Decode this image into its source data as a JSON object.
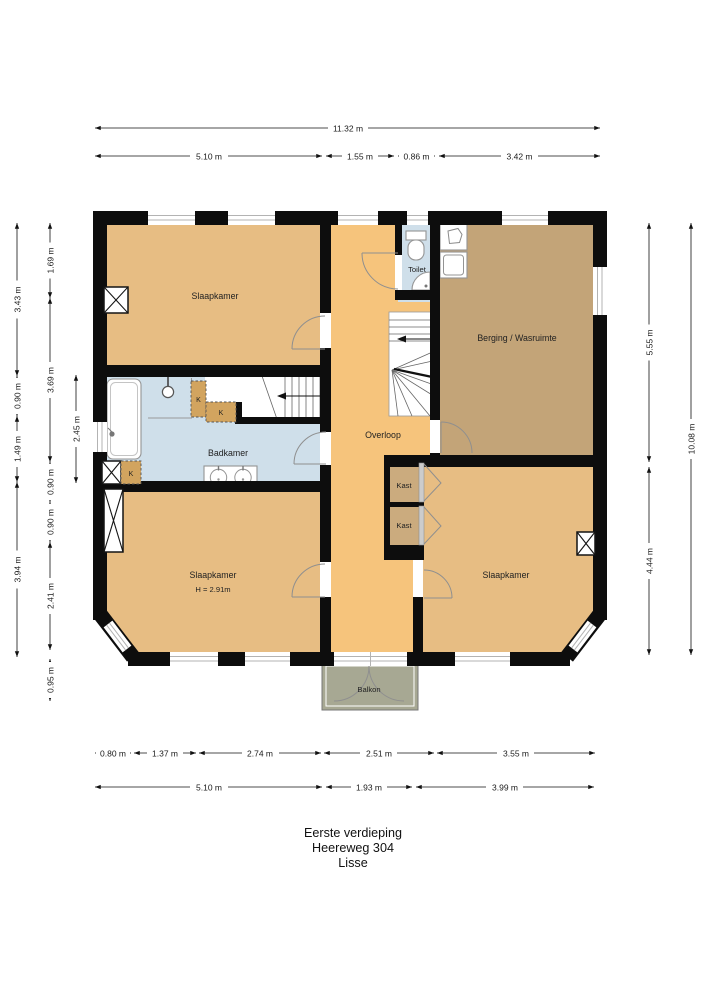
{
  "title": {
    "line1": "Eerste verdieping",
    "line2": "Heereweg 304",
    "line3": "Lisse"
  },
  "rooms": {
    "slaapkamer_tl": "Slaapkamer",
    "toilet": "Toilet",
    "berging": "Berging / Wasruimte",
    "overloop": "Overloop",
    "badkamer": "Badkamer",
    "kast1": "Kast",
    "kast2": "Kast",
    "slaapkamer_bl": "Slaapkamer",
    "slaapkamer_bl_height": "H = 2.91m",
    "slaapkamer_br": "Slaapkamer",
    "balkon": "Balkon",
    "k1": "K",
    "k2": "K",
    "k3": "K"
  },
  "dimensions": {
    "top": {
      "total": "11.32 m",
      "row2": [
        "5.10 m",
        "1.55 m",
        "0.86 m",
        "3.42 m"
      ]
    },
    "bottom": {
      "row1": [
        "0.80 m",
        "1.37 m",
        "2.74 m",
        "2.51 m",
        "3.55 m"
      ],
      "row2": [
        "5.10 m",
        "1.93 m",
        "3.99 m"
      ]
    },
    "left": {
      "outer": [
        "3.43 m",
        "0.90 m",
        "1.49 m",
        "3.94 m"
      ],
      "inner": [
        "1.69 m",
        "3.69 m",
        "0.90 m",
        "0.90 m",
        "2.41 m",
        "0.95 m"
      ],
      "badkamer": "2.45 m"
    },
    "right": {
      "inner": [
        "5.55 m",
        "4.44 m"
      ],
      "outer": "10.08 m"
    }
  },
  "colors": {
    "wall": "#0d0d0d",
    "slaapkamer_fill": "#e7bd83",
    "overloop_fill": "#f6c47c",
    "berging_fill": "#c3a478",
    "kast_fill": "#cbab7e",
    "bathroom_fill": "#cfdfea",
    "kbox_fill": "#d2a45f",
    "balkon_fill": "#a7a893",
    "window_line": "#b3b3b3",
    "door_arc": "#8f8f8f"
  }
}
